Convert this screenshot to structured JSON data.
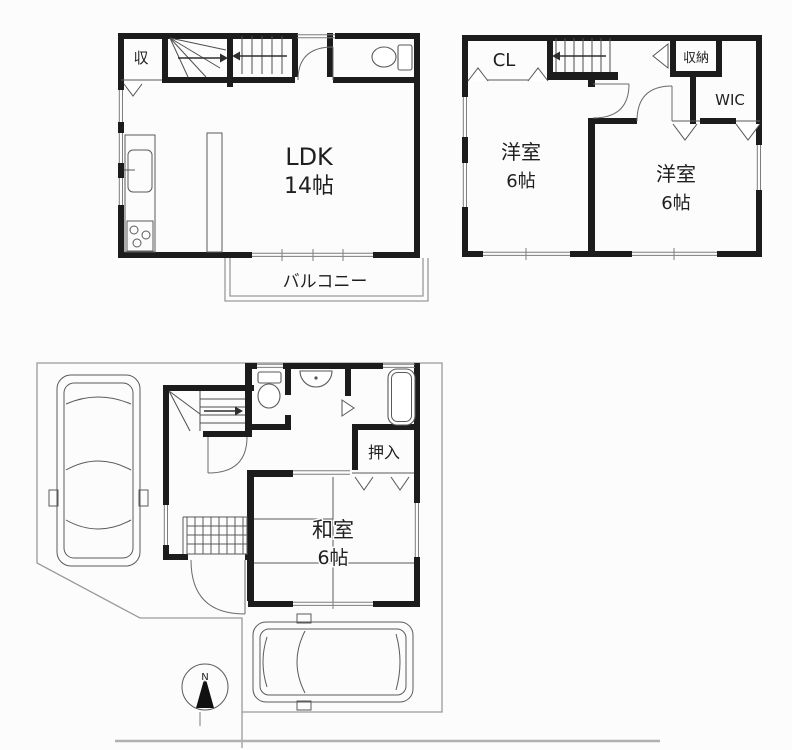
{
  "floor2": {
    "storage_label": "収",
    "room_label": "LDK",
    "room_size": "14帖",
    "balcony_label": "バルコニー"
  },
  "floor3": {
    "closet_label": "CL",
    "storage_label": "収納",
    "wic_label": "WIC",
    "room_left_label": "洋室",
    "room_left_size": "6帖",
    "room_right_label": "洋室",
    "room_right_size": "6帖"
  },
  "floor1": {
    "closet_label": "押入",
    "room_label": "和室",
    "room_size": "6帖",
    "compass_label": "N"
  },
  "style": {
    "wall_color": "#1c1c1c",
    "line_color": "#5a5a5a",
    "site_line_color": "#9a9a9a",
    "text_color": "#1f1f1f",
    "background": "#fcfcfc"
  }
}
